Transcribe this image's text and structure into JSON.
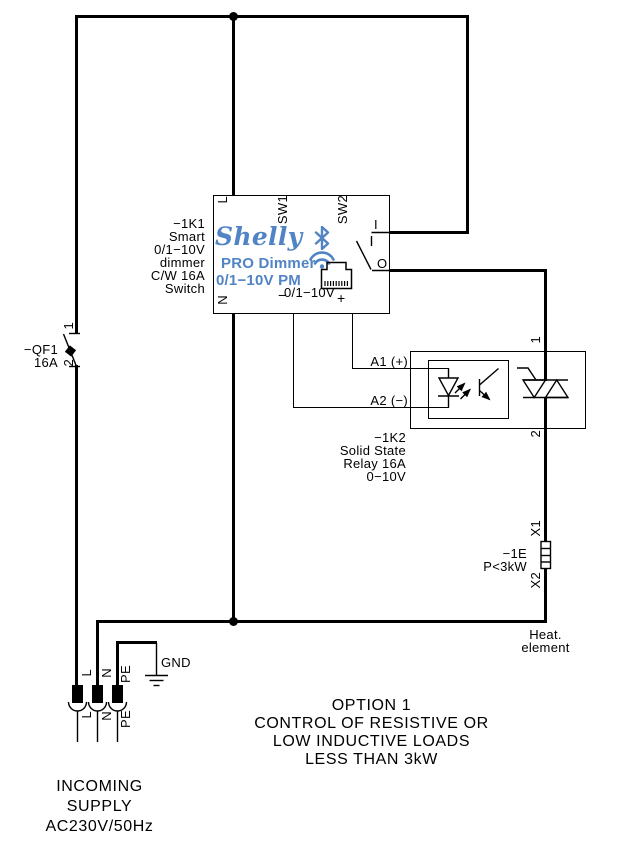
{
  "colors": {
    "brand_blue": "#5184c4",
    "line": "#000000",
    "background": "#ffffff"
  },
  "note": {
    "lines": [
      "OPTION 1",
      "CONTROL OF RESISTIVE OR",
      "LOW INDUCTIVE LOADS",
      "LESS THAN 3kW"
    ]
  },
  "incoming": {
    "lines": [
      "INCOMING",
      "SUPPLY",
      "AC230V/50Hz"
    ]
  },
  "breaker": {
    "designator": "−QF1",
    "rating": "16A",
    "terminal_1": "1",
    "terminal_2": "2"
  },
  "supply_terminals": {
    "l": "L",
    "n": "N",
    "pe": "PE",
    "gnd": "GND"
  },
  "dimmer": {
    "designator_lines": [
      "−1K1",
      "Smart",
      "0/1−10V",
      "dimmer",
      "C/W 16A",
      "Switch"
    ],
    "brand": "Shelly",
    "model_line1": "PRO Dimmer",
    "model_line2": "0/1−10V PM",
    "terminal_l": "L",
    "terminal_n": "N",
    "sw1": "SW1",
    "sw2": "SW2",
    "terminal_i": "I",
    "terminal_o": "O",
    "analog_label": "0/1−10V",
    "analog_minus": "−",
    "analog_plus": "+",
    "icons": {
      "bluetooth": "bluetooth-icon",
      "wifi": "wifi-icon",
      "ethernet": "ethernet-icon"
    }
  },
  "ssr": {
    "designator_lines": [
      "−1K2",
      "Solid State",
      "Relay 16A",
      "0−10V"
    ],
    "input_a1": "A1 (+)",
    "input_a2": "A2 (−)",
    "terminal_1": "1",
    "terminal_2": "2"
  },
  "heater": {
    "terminal_x1": "X1",
    "terminal_x2": "X2",
    "designator": "−1E",
    "rating": "P<3kW",
    "caption_lines": [
      "Heat.",
      "element"
    ]
  }
}
